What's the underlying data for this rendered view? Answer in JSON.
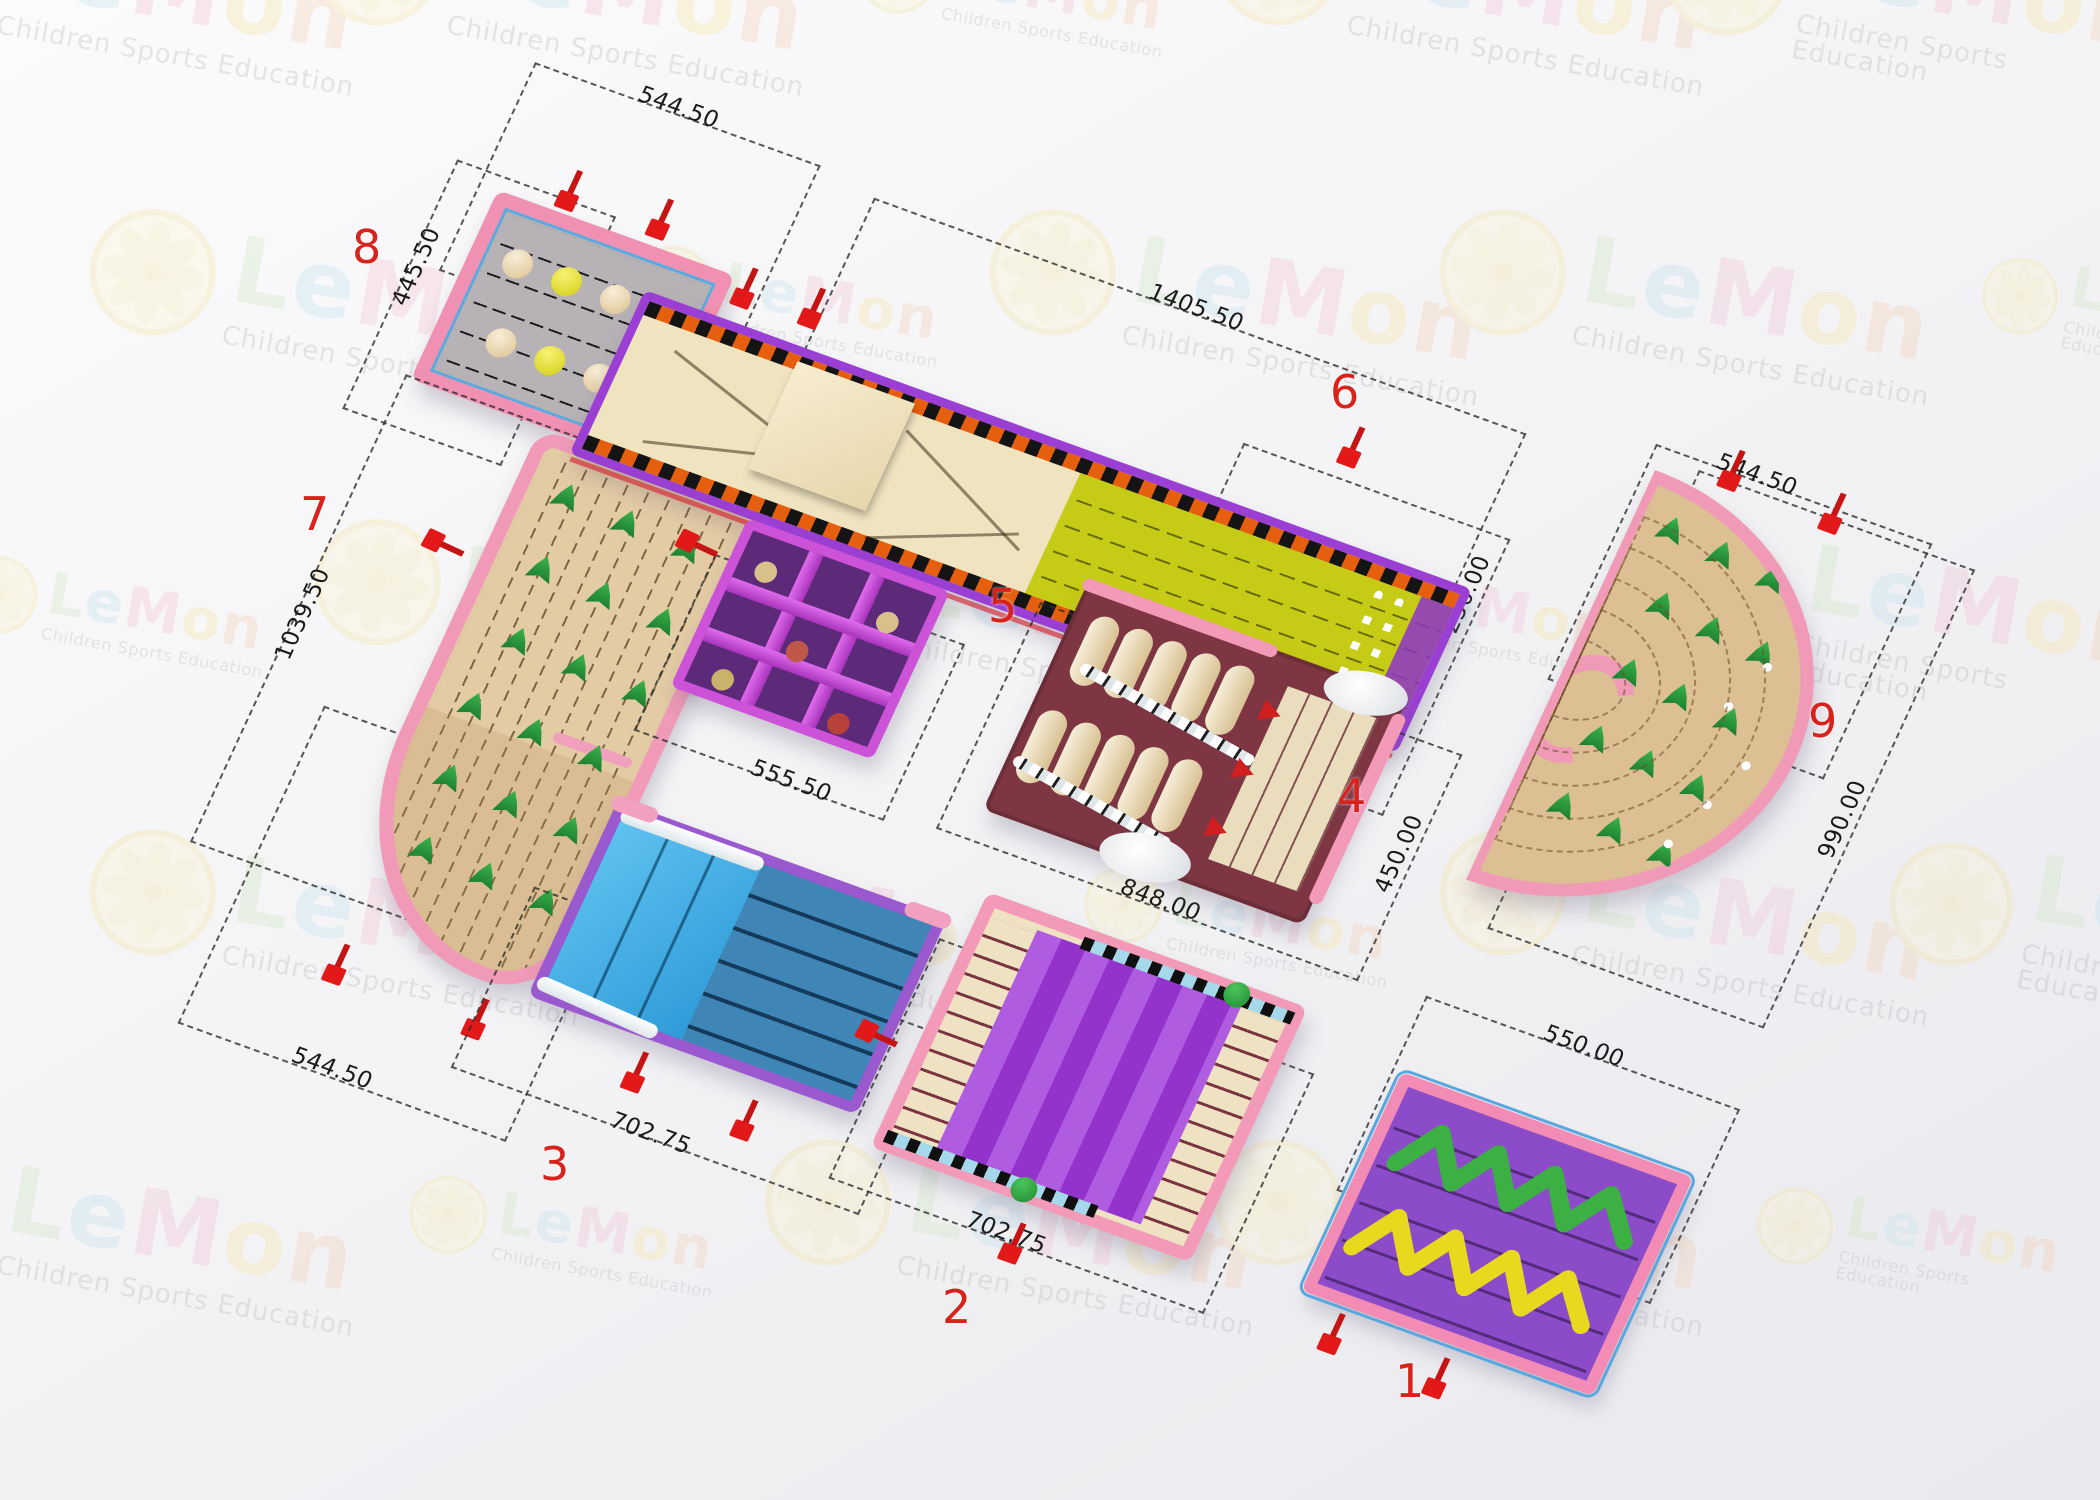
{
  "watermark": {
    "brand_letters": [
      "L",
      "e",
      "M",
      "o",
      "n"
    ],
    "brand_colors": [
      "#cfe6c2",
      "#bfe0ee",
      "#f2bfd4",
      "#f6e3a2",
      "#f3cdb0"
    ],
    "subtitle": "Children Sports Education"
  },
  "plan": {
    "sections": [
      {
        "id": "1",
        "label": "1",
        "kind": "spiral-lane-mat",
        "dims": {
          "top": "550.00"
        }
      },
      {
        "id": "2",
        "label": "2",
        "kind": "wave-slide",
        "dims": {
          "bottom": "702.75"
        }
      },
      {
        "id": "3",
        "label": "3",
        "kind": "blue-slide",
        "dims": {
          "bottom": "702.75"
        }
      },
      {
        "id": "4",
        "label": "4",
        "kind": "roller-obstacle",
        "dims": {
          "bottom": "848.00",
          "right": "450.00"
        }
      },
      {
        "id": "5",
        "label": "5",
        "kind": "climb-net",
        "dims": {
          "bottom": "555.50"
        }
      },
      {
        "id": "6",
        "label": "6",
        "kind": "ramp-slide-unit",
        "dims": {
          "top": "1405.50",
          "right": "250.00"
        }
      },
      {
        "id": "7",
        "label": "7",
        "kind": "curved-course",
        "dims": {
          "left": "1039.50",
          "bottom": "544.50"
        }
      },
      {
        "id": "8",
        "label": "8",
        "kind": "ball-course",
        "dims": {
          "top": "544.50",
          "left": "445.50"
        }
      },
      {
        "id": "9",
        "label": "9",
        "kind": "fan-course",
        "dims": {
          "top": "544.50",
          "right": "990.00"
        }
      }
    ],
    "decor": {
      "s8_ball_rows": [
        [
          "tan",
          "yellow",
          "tan",
          "yellow"
        ],
        [
          "tan",
          "yellow",
          "tan",
          "yellow"
        ]
      ],
      "s7_cone_count": 18,
      "s9_cone_count": 15,
      "s9_dot_count": 8,
      "s9_arc_count": 5,
      "s4_roller_rows": 2,
      "s4_rollers_per_row": 5,
      "s1_zigzag_colors": [
        "#3cb043",
        "#e8d91f"
      ]
    },
    "colors": {
      "border_pink": "#f090b2",
      "dim_line": "#2e2e2e",
      "number_red": "#d7231c",
      "yellow_lane": "#c6cb15",
      "purple_frame": "#9b3fd4",
      "maroon": "#7e3742",
      "blue_slide": "#3f85b5"
    }
  }
}
